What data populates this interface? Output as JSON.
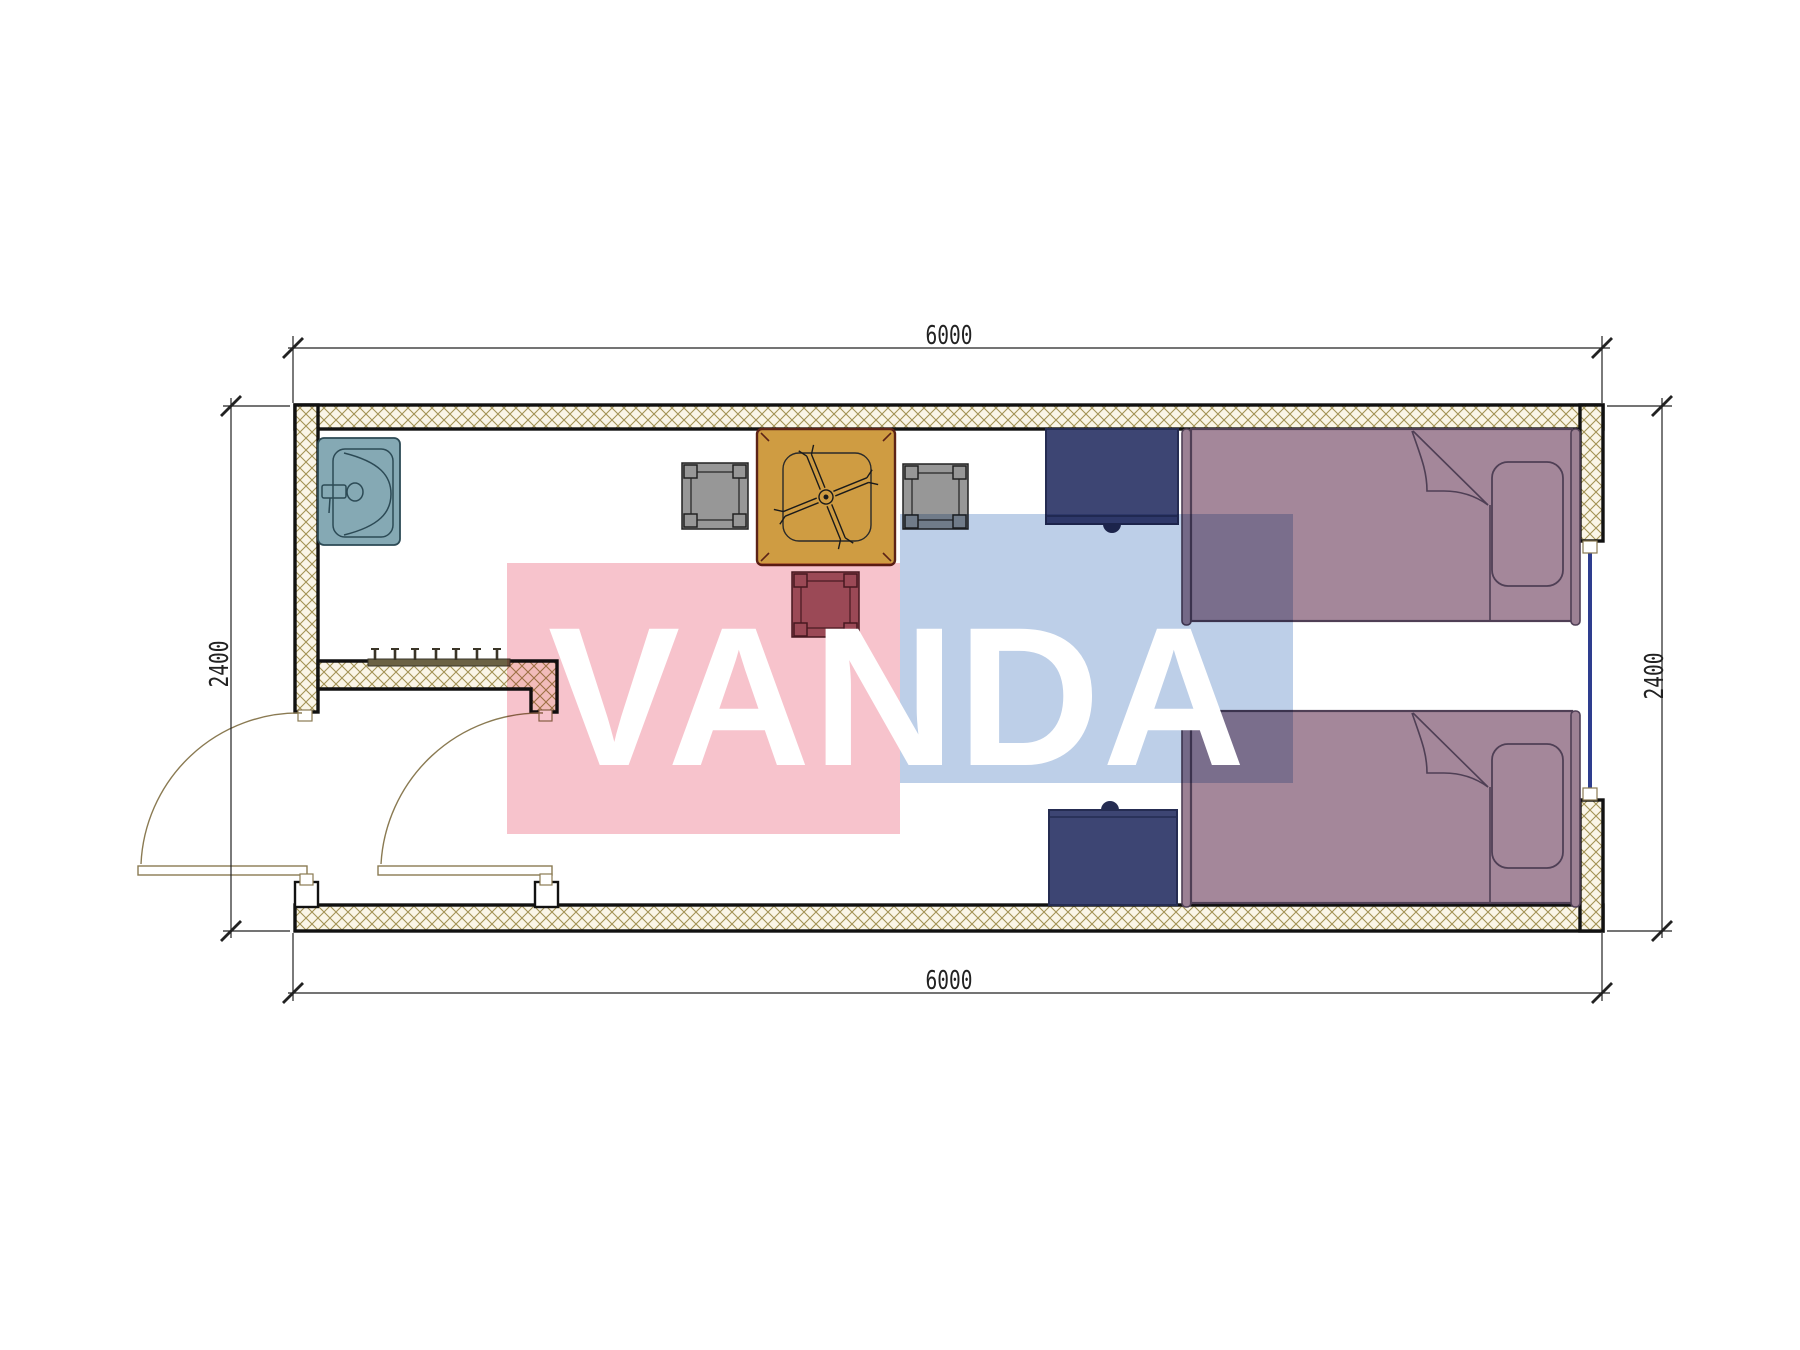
{
  "document": {
    "type": "architectural-floor-plan",
    "background": "#ffffff"
  },
  "watermark": {
    "text": "VANDA",
    "pink_rect_color": "#f7c3cc",
    "blue_rect_color": "#bdcfe8",
    "text_color": "#ffffff"
  },
  "dimensions": {
    "top": "6000",
    "bottom": "6000",
    "left": "2400",
    "right": "2400"
  },
  "plan_items": [
    {
      "name": "exterior-walls-hatched",
      "color": "#faf5e7"
    },
    {
      "name": "entry-partition-wall",
      "color": "#faf5e7"
    },
    {
      "name": "sink",
      "color": "#85a9b4"
    },
    {
      "name": "coat-rack-hooks",
      "color": "#6b6244"
    },
    {
      "name": "square-table-with-fan-symbol",
      "color": "#cf9c42"
    },
    {
      "name": "chair-gray-left",
      "color": "#979797"
    },
    {
      "name": "chair-gray-right",
      "color": "#979797"
    },
    {
      "name": "chair-red-bottom",
      "color": "#a05f6b"
    },
    {
      "name": "nightstand-top",
      "color": "#3d4573"
    },
    {
      "name": "nightstand-bottom",
      "color": "#3d4573"
    },
    {
      "name": "bed-top",
      "color": "#a4879a"
    },
    {
      "name": "bed-bottom",
      "color": "#a4879a"
    },
    {
      "name": "window-right-wall",
      "color": "#2e3d8f"
    },
    {
      "name": "exterior-door-swing",
      "color": "#8a7a52"
    },
    {
      "name": "interior-door-swing",
      "color": "#8a7a52"
    }
  ],
  "colors": {
    "wall-line": "#111111",
    "hatch-bg": "#faf5e7",
    "hatch-line": "#a29254",
    "door": "#8a7a52",
    "sink": "#85a9b4",
    "sink-dark": "#2c4a55",
    "table": "#cf9c42",
    "table-dark": "#5c2317",
    "chair": "#979797",
    "chair-dark": "#222222",
    "chair-red": "#a05f6b",
    "chair-red-dark": "#491f27",
    "navy": "#3d4573",
    "navy-dark": "#252c52",
    "bed": "#a4879a",
    "bed-bar": "#9c8194",
    "bed-dark": "#4f3f55",
    "rack": "#6b6244",
    "rack-dark": "#3a3528",
    "window": "#2e3d8f",
    "dim": "#222222",
    "wm-pink": "#f7c3cc",
    "wm-blue": "#bdcfe8",
    "wm-text": "#ffffff",
    "page-bg": "#ffffff"
  }
}
